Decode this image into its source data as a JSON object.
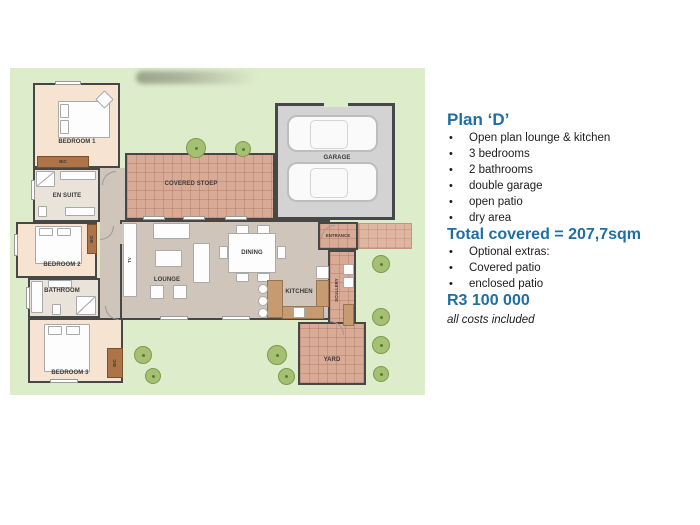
{
  "panel": {
    "title": "Plan ‘D’",
    "features": [
      "Open plan lounge & kitchen",
      "3 bedrooms",
      "2 bathrooms",
      "double garage",
      "open patio",
      "dry area"
    ],
    "total": "Total covered = 207,7sqm",
    "extras": [
      "Optional extras:",
      "Covered patio",
      "enclosed patio"
    ],
    "price": "R3 100 000",
    "note": "all costs included"
  },
  "plan": {
    "labels": {
      "bedroom1": "BEDROOM 1",
      "bedroom2": "BEDROOM 2",
      "bedroom3": "BEDROOM 3",
      "ensuite": "EN SUITE",
      "bathroom": "BATHROOM",
      "lounge": "LOUNGE",
      "dining": "DINING",
      "kitchen": "KITCHEN",
      "scullery": "SCULLERY",
      "entrance": "ENTRANCE",
      "garage": "GARAGE",
      "stoep": "COVERED STOEP",
      "yard": "YARD",
      "bic": "BIC",
      "tv": "TV"
    },
    "colors": {
      "lawn": "#ddeccb",
      "bedroom_fill": "#f6e3d2",
      "living_fill": "#cfc5ba",
      "brick_fill": "#d9aa96",
      "garage_fill": "#d3d3d3",
      "wall": "#474747",
      "cupboard": "#ad7448",
      "accent_blue": "#1d6fa5"
    }
  }
}
